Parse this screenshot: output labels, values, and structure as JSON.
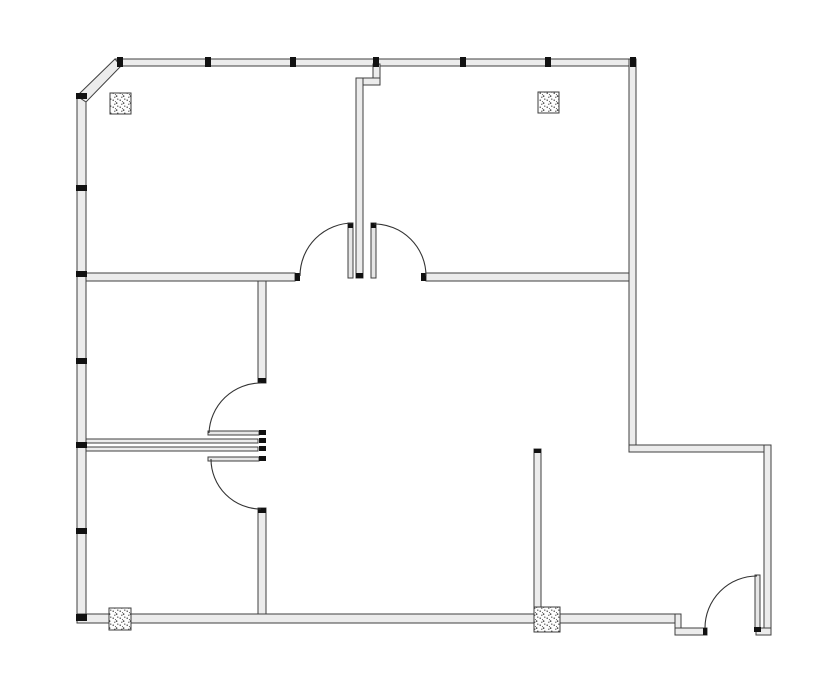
{
  "meta": {
    "app": "floor-plan-drawing",
    "description": "Monochrome architectural floor plan: L-shaped office suite with chamfered top-left corner, five swing doors, window mullion ticks on north and west walls, and four stippled structural columns"
  },
  "canvas": {
    "width": 835,
    "height": 678,
    "background": "#ffffff"
  },
  "colors": {
    "wall_fill": "#ececec",
    "wall_stroke": "#3f3f3f",
    "tick": "#111111",
    "arc_stroke": "#333333",
    "leaf_fill": "#e6e6e6",
    "column_fill": "#fdfdfd",
    "column_stroke": "#3c3c3c",
    "column_dot": "#333333"
  },
  "walls": [
    {
      "name": "exterior-wall-top",
      "r": [
        115,
        59,
        521,
        7
      ]
    },
    {
      "name": "exterior-wall-left",
      "r": [
        77,
        96,
        9,
        527
      ]
    },
    {
      "name": "exterior-wall-right-upper",
      "r": [
        629,
        59,
        7,
        393
      ]
    },
    {
      "name": "exterior-wall-step-east",
      "r": [
        629,
        445,
        142,
        7
      ]
    },
    {
      "name": "exterior-wall-right-lower",
      "r": [
        764,
        445,
        7,
        190
      ]
    },
    {
      "name": "exterior-wall-bottom-main",
      "r": [
        77,
        614,
        604,
        9
      ]
    },
    {
      "name": "exterior-wall-bottom-step",
      "r": [
        675,
        614,
        6,
        21
      ]
    },
    {
      "name": "exterior-wall-bottom-lower-left",
      "r": [
        675,
        628,
        32,
        7
      ]
    },
    {
      "name": "exterior-wall-bottom-lower-right",
      "r": [
        756,
        628,
        15,
        7
      ]
    },
    {
      "name": "interior-wall-stub-top",
      "r": [
        373,
        64,
        7,
        21
      ]
    },
    {
      "name": "interior-wall-jog",
      "r": [
        356,
        78,
        24,
        7
      ]
    },
    {
      "name": "interior-wall-central-vertical",
      "r": [
        356,
        78,
        7,
        200
      ]
    },
    {
      "name": "interior-wall-mid-horizontal-left",
      "r": [
        86,
        273,
        209,
        8
      ]
    },
    {
      "name": "interior-wall-mid-horizontal-right",
      "r": [
        426,
        273,
        203,
        8
      ]
    },
    {
      "name": "interior-wall-west-vertical-upper",
      "r": [
        258,
        281,
        8,
        102
      ]
    },
    {
      "name": "interior-wall-west-vertical-lower",
      "r": [
        258,
        508,
        8,
        106
      ]
    },
    {
      "name": "interior-wall-corridor-upper",
      "r": [
        86,
        439,
        172,
        4
      ]
    },
    {
      "name": "interior-wall-corridor-lower",
      "r": [
        86,
        447,
        172,
        4
      ]
    },
    {
      "name": "interior-wall-bottom-middle-vertical",
      "r": [
        534,
        449,
        7,
        158
      ]
    }
  ],
  "chamfer": {
    "name": "exterior-wall-chamfer",
    "points": "77,96 115,59 121,66 86,102"
  },
  "window_ticks": [
    {
      "name": "mullion-tick-top-1",
      "r": [
        117,
        57,
        6,
        10
      ]
    },
    {
      "name": "mullion-tick-top-2",
      "r": [
        205,
        57,
        6,
        10
      ]
    },
    {
      "name": "mullion-tick-top-3",
      "r": [
        290,
        57,
        6,
        10
      ]
    },
    {
      "name": "mullion-tick-top-4",
      "r": [
        373,
        57,
        6,
        10
      ]
    },
    {
      "name": "mullion-tick-top-5",
      "r": [
        460,
        57,
        6,
        10
      ]
    },
    {
      "name": "mullion-tick-top-6",
      "r": [
        545,
        57,
        6,
        10
      ]
    },
    {
      "name": "mullion-tick-top-corner",
      "r": [
        630,
        57,
        6,
        10
      ]
    },
    {
      "name": "mullion-tick-left-1",
      "r": [
        76,
        93,
        11,
        6
      ]
    },
    {
      "name": "mullion-tick-left-2",
      "r": [
        76,
        185,
        11,
        6
      ]
    },
    {
      "name": "mullion-tick-left-3",
      "r": [
        76,
        271,
        11,
        6
      ]
    },
    {
      "name": "mullion-tick-left-4",
      "r": [
        76,
        358,
        11,
        6
      ]
    },
    {
      "name": "mullion-tick-left-5",
      "r": [
        76,
        442,
        11,
        6
      ]
    },
    {
      "name": "mullion-tick-left-6",
      "r": [
        76,
        528,
        11,
        6
      ]
    },
    {
      "name": "mullion-tick-left-corner",
      "r": [
        76,
        614,
        11,
        7
      ]
    }
  ],
  "caps": [
    {
      "name": "door-jamb-mid-wall-left",
      "r": [
        295,
        273,
        5,
        8
      ]
    },
    {
      "name": "door-jamb-mid-wall-right",
      "r": [
        421,
        273,
        5,
        8
      ]
    },
    {
      "name": "wall-end-cap-central",
      "r": [
        356,
        273,
        7,
        5
      ]
    },
    {
      "name": "door-leaf-cap-top-left",
      "r": [
        348,
        223,
        5,
        5
      ]
    },
    {
      "name": "door-leaf-cap-top-right",
      "r": [
        371,
        223,
        5,
        5
      ]
    },
    {
      "name": "wall-end-cap-west-upper",
      "r": [
        258,
        378,
        8,
        5
      ]
    },
    {
      "name": "wall-end-cap-west-lower",
      "r": [
        258,
        508,
        8,
        5
      ]
    },
    {
      "name": "hinge-cap-west-1",
      "r": [
        259,
        430,
        7,
        5
      ]
    },
    {
      "name": "hinge-cap-west-2",
      "r": [
        259,
        438,
        7,
        5
      ]
    },
    {
      "name": "hinge-cap-west-3",
      "r": [
        259,
        446,
        7,
        5
      ]
    },
    {
      "name": "hinge-cap-west-4",
      "r": [
        259,
        456,
        7,
        5
      ]
    },
    {
      "name": "wall-end-cap-bottom-middle",
      "r": [
        534,
        449,
        7,
        4
      ]
    },
    {
      "name": "door-jamb-bottom-right",
      "r": [
        703,
        628,
        4,
        7
      ]
    },
    {
      "name": "hinge-cap-bottom-right",
      "r": [
        754,
        627,
        7,
        5
      ]
    }
  ],
  "columns": [
    {
      "name": "column-top-left",
      "r": [
        110,
        93,
        21,
        21
      ]
    },
    {
      "name": "column-top-right",
      "r": [
        538,
        92,
        21,
        21
      ]
    },
    {
      "name": "column-bottom-left",
      "r": [
        109,
        608,
        22,
        22
      ]
    },
    {
      "name": "column-bottom-middle",
      "r": [
        534,
        607,
        26,
        25
      ]
    }
  ],
  "door_leaves": [
    {
      "name": "door-leaf-top-left-room",
      "r": [
        348,
        223,
        5,
        55
      ]
    },
    {
      "name": "door-leaf-top-right-room",
      "r": [
        371,
        223,
        5,
        55
      ]
    },
    {
      "name": "door-leaf-west-upper",
      "r": [
        208,
        431,
        51,
        4
      ]
    },
    {
      "name": "door-leaf-west-lower",
      "r": [
        208,
        457,
        51,
        4
      ]
    },
    {
      "name": "door-leaf-bottom-right",
      "r": [
        755,
        575,
        5,
        53
      ]
    }
  ],
  "door_arcs": [
    {
      "name": "door-swing-arc-top-left-room",
      "d": "M 300 276 A 53 53 0 0 1 353 223"
    },
    {
      "name": "door-swing-arc-top-right-room",
      "d": "M 374 224 A 52 52 0 0 1 426 276"
    },
    {
      "name": "door-swing-arc-west-upper",
      "d": "M 209 433 A 52 52 0 0 1 261 383"
    },
    {
      "name": "door-swing-arc-west-lower",
      "d": "M 261 509 A 50 50 0 0 1 211 459"
    },
    {
      "name": "door-swing-arc-bottom-right",
      "d": "M 705 628 A 52 52 0 0 1 757 576"
    }
  ]
}
